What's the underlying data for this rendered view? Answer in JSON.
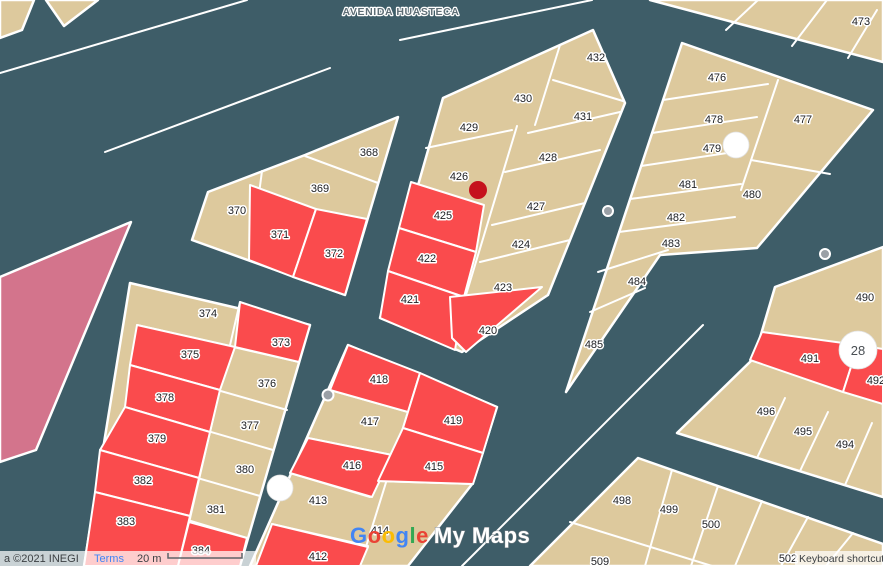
{
  "street": {
    "label": "AVENIDA HUASTECA"
  },
  "labels": {
    "p473": "473",
    "p432": "432",
    "p430": "430",
    "p431": "431",
    "p429": "429",
    "p428": "428",
    "p426": "426",
    "p427": "427",
    "p424": "424",
    "p423": "423",
    "p368": "368",
    "p369": "369",
    "p370": "370",
    "p371": "371",
    "p372": "372",
    "p374": "374",
    "p373": "373",
    "p375": "375",
    "p376": "376",
    "p378": "378",
    "p377": "377",
    "p379": "379",
    "p380": "380",
    "p382": "382",
    "p381": "381",
    "p383": "383",
    "p384": "384",
    "p425": "425",
    "p422": "422",
    "p421": "421",
    "p420": "420",
    "p418": "418",
    "p417": "417",
    "p419": "419",
    "p416": "416",
    "p415": "415",
    "p413": "413",
    "p414": "414",
    "p412": "412",
    "p484": "484",
    "p485": "485",
    "p476": "476",
    "p478": "478",
    "p477": "477",
    "p479": "479",
    "p481": "481",
    "p480": "480",
    "p482": "482",
    "p483": "483",
    "p490": "490",
    "p491": "491",
    "p492": "492",
    "p496": "496",
    "p495": "495",
    "p494": "494",
    "p498": "498",
    "p499": "499",
    "p500": "500",
    "p509": "509",
    "p502": "502"
  },
  "markers": {
    "lot_number": "28"
  },
  "watermark": {
    "letters": [
      "G",
      "o",
      "o",
      "g",
      "l",
      "e"
    ],
    "suffix": "My Maps"
  },
  "attribution": {
    "copyright": "a ©2021 INEGI",
    "terms": "Terms",
    "scale_label": "20 m",
    "keyboard_shortcuts": "Keyboard shortcuts"
  },
  "colors": {
    "road": "#3e5d68",
    "parcel": "#ddc99d",
    "parcel_highlight": "#fa4b4d",
    "large_parcel_pink": "#d3748c",
    "marker_red": "#c5121d",
    "marker_gray": "#9aa0a6",
    "marker_white": "#ffffff",
    "label_text": "#202124",
    "street_label": "#5e6e76",
    "link_blue": "#4285f4",
    "google_logo": [
      "#4285F4",
      "#EA4335",
      "#FBBC04",
      "#4285F4",
      "#34A853",
      "#EA4335"
    ]
  }
}
